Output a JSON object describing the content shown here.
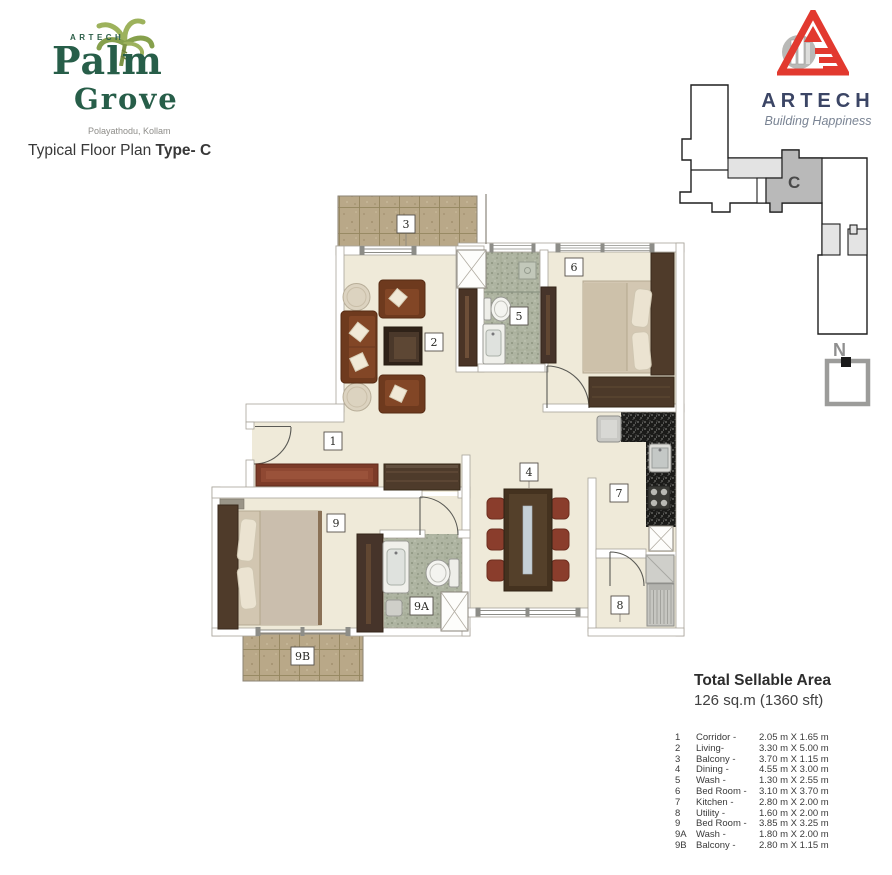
{
  "brand": {
    "artech_small": "ARTECH",
    "palm": "Palm",
    "grove": "Grove",
    "location": "Polayathodu, Kollam"
  },
  "title": {
    "prefix": "Typical Floor Plan ",
    "type": "Type- C"
  },
  "developer": {
    "name": "ARTECH",
    "tagline": "Building Happiness"
  },
  "site_key": {
    "unit": "C"
  },
  "north": {
    "label": "N"
  },
  "plan": {
    "labels": [
      "1",
      "2",
      "3",
      "4",
      "5",
      "6",
      "7",
      "8",
      "9",
      "9A",
      "9B"
    ]
  },
  "legend": {
    "title": "Total Sellable Area",
    "area": "126 sq.m (1360 sft)",
    "rows": [
      {
        "num": "1",
        "name": "Corridor -",
        "dims": "2.05 m X 1.65 m"
      },
      {
        "num": "2",
        "name": "Living-",
        "dims": "3.30 m X 5.00 m"
      },
      {
        "num": "3",
        "name": "Balcony -",
        "dims": "3.70 m X 1.15 m"
      },
      {
        "num": "4",
        "name": "Dining -",
        "dims": "4.55 m X 3.00 m"
      },
      {
        "num": "5",
        "name": "Wash -",
        "dims": "1.30 m X 2.55 m"
      },
      {
        "num": "6",
        "name": "Bed Room -",
        "dims": "3.10 m X 3.70 m"
      },
      {
        "num": "7",
        "name": "Kitchen -",
        "dims": "2.80 m X 2.00 m"
      },
      {
        "num": "8",
        "name": "Utility  -",
        "dims": "1.60 m X 2.00 m"
      },
      {
        "num": "9",
        "name": "Bed Room -",
        "dims": "3.85 m X 3.25 m"
      },
      {
        "num": "9A",
        "name": "Wash -",
        "dims": "1.80 m X 2.00 m"
      },
      {
        "num": "9B",
        "name": "Balcony -",
        "dims": "2.80 m X 1.15 m"
      }
    ]
  },
  "colors": {
    "brand_green": "#275e49",
    "palm_leaf": "#9db25c",
    "artech_red": "#e2392f",
    "artech_navy": "#3b4565",
    "floor_cream": "#efead9",
    "balcony_tile": "#b9a888",
    "bath_tile": "#aeb4a1",
    "granite": "#1b1b19",
    "sofa_brown": "#6e3a1e",
    "rug_red": "#7c3b28"
  }
}
